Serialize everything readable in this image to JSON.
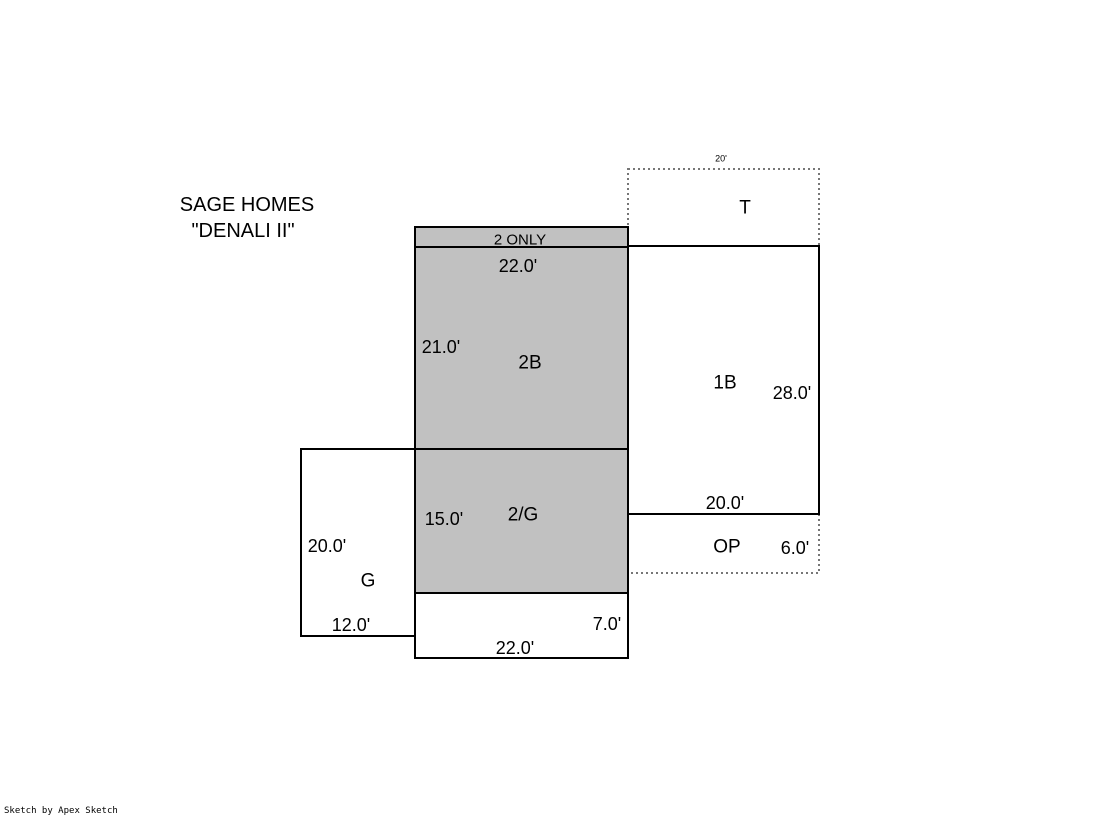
{
  "title": {
    "line1": "SAGE HOMES",
    "line2": "\"DENALI II\""
  },
  "plan": {
    "t_area": {
      "label": "T",
      "top_width": "20'"
    },
    "second_floor": {
      "strip_note": "2 ONLY",
      "top_width": "22.0'",
      "left_height": "21.0'",
      "label": "2B"
    },
    "first_floor": {
      "label": "1B",
      "right_height": "28.0'",
      "bottom_width": "20.0'"
    },
    "second_over_garage": {
      "label": "2/G",
      "left_height": "15.0'"
    },
    "garage": {
      "label": "G",
      "left_height": "20.0'",
      "bottom_width": "12.0'"
    },
    "open_porch": {
      "label": "OP",
      "width": "6.0'"
    },
    "lower_section": {
      "right_height": "7.0'",
      "bottom_width": "22.0'"
    }
  },
  "colors": {
    "area_fill": "#c1c1c1",
    "white_fill": "#ffffff",
    "outline": "#000000",
    "dotted_outline": "#767676",
    "background": "#ffffff"
  },
  "footer": {
    "credit": "Sketch by Apex Sketch"
  }
}
